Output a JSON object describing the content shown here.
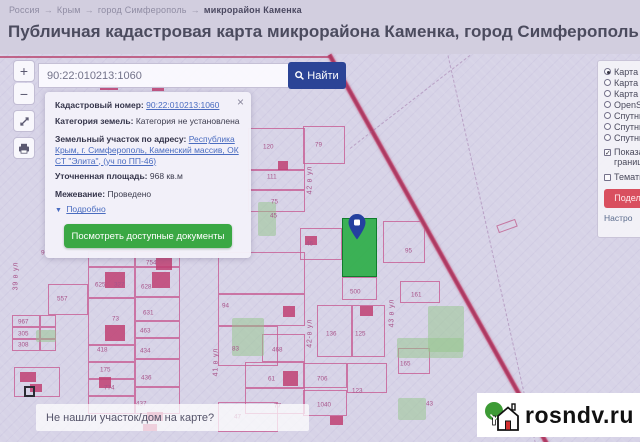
{
  "breadcrumb": {
    "parts": [
      "Россия",
      "Крым",
      "город Симферополь"
    ],
    "current": "микрорайон Каменка",
    "separator": "→"
  },
  "header": {
    "title": "Публичная кадастровая карта микрорайона Каменка, город Симферополь",
    "date_note": "на 23.06.2020"
  },
  "search": {
    "value": "90:22:010213:1060",
    "button_label": "Найти"
  },
  "map_controls": {
    "zoom_in": "+",
    "zoom_out": "−"
  },
  "icons": {
    "close": "×",
    "details_arrow": "▼",
    "check": "✓"
  },
  "popup": {
    "cadastral_number_label": "Кадастровый номер:",
    "cadastral_number": "90:22:010213:1060",
    "category_label": "Категория земель:",
    "category": "Категория не установлена",
    "address_label": "Земельный участок по адресу:",
    "address": "Республика Крым, г. Симферополь, Каменский массив, ОК СТ \"Элита\", (уч по ПП-46)",
    "area_label": "Уточненная площадь:",
    "area": "968 кв.м",
    "survey_label": "Межевание:",
    "survey": "Проведено",
    "details_link": "Подробно",
    "documents_button": "Посмотреть доступные документы"
  },
  "layers_panel": {
    "options": [
      {
        "label": "Карта",
        "selected": true
      },
      {
        "label": "Карта",
        "selected": false
      },
      {
        "label": "Карта",
        "selected": false
      },
      {
        "label": "OpenS",
        "selected": false
      },
      {
        "label": "Спутни",
        "selected": false
      },
      {
        "label": "Спутни",
        "selected": false
      },
      {
        "label": "Спутни",
        "selected": false
      }
    ],
    "checkboxes": [
      {
        "label": "Показать границы",
        "checked": true
      },
      {
        "label": "Тематич",
        "checked": false
      }
    ],
    "share_button": "Подели",
    "settings_link": "Настро"
  },
  "map": {
    "question_text": "Не нашли участок/дом на карте?",
    "selected_parcel": {
      "x": 342,
      "y": 164,
      "w": 35,
      "h": 59
    },
    "streets": [
      {
        "name": "39 в ул",
        "x": 10,
        "y": 204
      },
      {
        "name": "41 в ул",
        "x": 210,
        "y": 290
      },
      {
        "name": "42 в ул",
        "x": 304,
        "y": 108
      },
      {
        "name": "42-в ул",
        "x": 304,
        "y": 261
      },
      {
        "name": "43 в ул",
        "x": 386,
        "y": 241
      }
    ],
    "cells": [
      [
        12,
        261,
        28,
        12
      ],
      [
        40,
        261,
        16,
        12
      ],
      [
        12,
        273,
        28,
        12
      ],
      [
        40,
        273,
        16,
        12
      ],
      [
        12,
        285,
        28,
        12
      ],
      [
        40,
        285,
        16,
        12
      ],
      [
        48,
        230,
        40,
        31
      ],
      [
        14,
        313,
        46,
        30
      ],
      [
        88,
        197,
        47,
        16
      ],
      [
        135,
        197,
        45,
        16
      ],
      [
        88,
        213,
        47,
        31
      ],
      [
        135,
        213,
        45,
        30
      ],
      [
        135,
        243,
        45,
        24
      ],
      [
        88,
        244,
        47,
        47
      ],
      [
        135,
        267,
        45,
        17
      ],
      [
        135,
        284,
        45,
        21
      ],
      [
        88,
        291,
        47,
        17
      ],
      [
        88,
        308,
        47,
        17
      ],
      [
        135,
        305,
        45,
        28
      ],
      [
        88,
        325,
        47,
        17
      ],
      [
        135,
        333,
        45,
        27
      ],
      [
        88,
        342,
        47,
        18
      ],
      [
        218,
        198,
        87,
        42
      ],
      [
        218,
        240,
        87,
        32
      ],
      [
        218,
        272,
        60,
        40
      ],
      [
        262,
        280,
        43,
        28
      ],
      [
        245,
        308,
        60,
        26
      ],
      [
        245,
        334,
        60,
        26
      ],
      [
        218,
        348,
        60,
        30
      ],
      [
        248,
        74,
        57,
        42
      ],
      [
        303,
        72,
        42,
        38
      ],
      [
        248,
        116,
        57,
        20
      ],
      [
        248,
        136,
        57,
        22
      ],
      [
        300,
        174,
        42,
        32
      ],
      [
        383,
        167,
        42,
        42
      ],
      [
        342,
        223,
        35,
        23
      ],
      [
        400,
        227,
        40,
        22
      ],
      [
        317,
        251,
        35,
        52
      ],
      [
        352,
        251,
        33,
        52
      ],
      [
        303,
        309,
        44,
        25
      ],
      [
        303,
        336,
        44,
        26
      ],
      [
        347,
        309,
        40,
        30
      ],
      [
        398,
        294,
        32,
        26
      ]
    ],
    "parcel_labels": [
      [
        "96",
        41,
        195
      ],
      [
        "557",
        57,
        241
      ],
      [
        "967",
        18,
        264
      ],
      [
        "305",
        18,
        276
      ],
      [
        "308",
        18,
        287
      ],
      [
        "754",
        146,
        205
      ],
      [
        "625",
        95,
        227
      ],
      [
        "327",
        114,
        227
      ],
      [
        "628",
        141,
        229
      ],
      [
        "631",
        143,
        255
      ],
      [
        "73",
        112,
        261
      ],
      [
        "463",
        140,
        273
      ],
      [
        "434",
        140,
        293
      ],
      [
        "418",
        97,
        292
      ],
      [
        "175",
        100,
        312
      ],
      [
        "436",
        141,
        320
      ],
      [
        "774",
        104,
        330
      ],
      [
        "437",
        136,
        346
      ],
      [
        "94",
        222,
        248
      ],
      [
        "83",
        232,
        291
      ],
      [
        "468",
        272,
        292
      ],
      [
        "61",
        268,
        321
      ],
      [
        "77",
        274,
        348
      ],
      [
        "47",
        234,
        359
      ],
      [
        "120",
        263,
        89
      ],
      [
        "79",
        315,
        87
      ],
      [
        "111",
        267,
        119
      ],
      [
        "75",
        271,
        144
      ],
      [
        "45",
        270,
        158
      ],
      [
        "46",
        306,
        186
      ],
      [
        "136",
        326,
        276
      ],
      [
        "125",
        355,
        276
      ],
      [
        "706",
        317,
        321
      ],
      [
        "1040",
        317,
        347
      ],
      [
        "123",
        352,
        333
      ],
      [
        "500",
        350,
        234
      ],
      [
        "161",
        411,
        237
      ],
      [
        "95",
        405,
        193
      ],
      [
        "165",
        400,
        306
      ],
      [
        "43",
        426,
        346
      ]
    ],
    "buildings": [
      [
        105,
        218,
        20,
        16
      ],
      [
        156,
        204,
        16,
        12
      ],
      [
        152,
        218,
        18,
        16
      ],
      [
        105,
        271,
        20,
        16
      ],
      [
        283,
        252,
        12,
        11
      ],
      [
        360,
        252,
        13,
        10
      ],
      [
        283,
        317,
        15,
        15
      ],
      [
        99,
        323,
        12,
        11
      ],
      [
        20,
        318,
        16,
        10
      ],
      [
        30,
        330,
        12,
        8
      ],
      [
        147,
        358,
        16,
        9
      ],
      [
        143,
        370,
        14,
        7
      ],
      [
        278,
        107,
        10,
        9
      ],
      [
        305,
        182,
        12,
        9
      ],
      [
        330,
        362,
        13,
        9
      ],
      [
        100,
        31,
        18,
        5
      ],
      [
        152,
        32,
        12,
        5
      ]
    ],
    "dashed_building": [
      24,
      332,
      11,
      11
    ],
    "green_areas": [
      [
        232,
        264,
        32,
        38
      ],
      [
        397,
        284,
        66,
        20
      ],
      [
        428,
        252,
        36,
        46
      ],
      [
        398,
        344,
        28,
        22
      ],
      [
        36,
        276,
        20,
        12
      ],
      [
        258,
        148,
        18,
        34
      ]
    ]
  },
  "watermark": {
    "text": "rosndv.ru"
  }
}
